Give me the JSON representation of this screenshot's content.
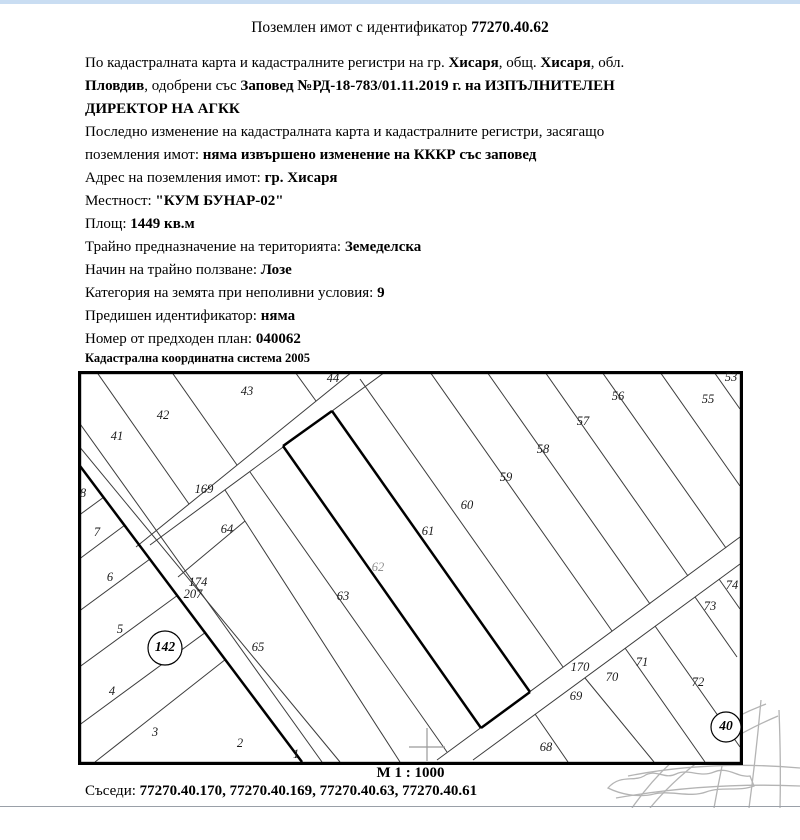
{
  "page": {
    "title_prefix": "Поземлен имот с идентификатор ",
    "title_id": "77270.40.62",
    "paragraphs": [
      [
        {
          "t": "По кадастралната карта и кадастралните регистри на гр. "
        },
        {
          "t": "Хисаря",
          "b": 1
        },
        {
          "t": ", общ. "
        },
        {
          "t": "Хисаря",
          "b": 1
        },
        {
          "t": ", обл. "
        },
        {
          "t": "Пловдив",
          "b": 1
        },
        {
          "t": ", одобрени със "
        },
        {
          "t": "Заповед №РД-18-783/01.11.2019 г. на ИЗПЪЛНИТЕЛЕН ДИРЕКТОР НА АГКК",
          "b": 1
        }
      ],
      [
        {
          "t": "Последно изменение на кадастралната карта и кадастралните регистри, засягащо поземления имот: "
        },
        {
          "t": "няма извършено изменение на КККР със заповед",
          "b": 1
        }
      ],
      [
        {
          "t": "Адрес на поземления имот: "
        },
        {
          "t": "гр. Хисаря",
          "b": 1
        }
      ],
      [
        {
          "t": "Местност: "
        },
        {
          "t": "\"КУМ БУНАР-02\"",
          "b": 1
        }
      ],
      [
        {
          "t": "Площ: "
        },
        {
          "t": "1449 кв.м",
          "b": 1
        }
      ],
      [
        {
          "t": "Трайно предназначение на територията: "
        },
        {
          "t": "Земеделска",
          "b": 1
        }
      ],
      [
        {
          "t": "Начин на трайно ползване: "
        },
        {
          "t": "Лозе",
          "b": 1
        }
      ],
      [
        {
          "t": "Категория на земята при неполивни условия: "
        },
        {
          "t": "9",
          "b": 1
        }
      ],
      [
        {
          "t": "Предишен идентификатор: "
        },
        {
          "t": "няма",
          "b": 1
        }
      ],
      [
        {
          "t": "Номер от предходен план: "
        },
        {
          "t": "040062",
          "b": 1
        }
      ]
    ],
    "coord_system": "Кадастрална координатна система 2005",
    "scale": "М 1 : 1000",
    "neighbors_label": "Съседи: ",
    "neighbors": "77270.40.170, 77270.40.169, 77270.40.63, 77270.40.61"
  },
  "map": {
    "subject_parcel": "62",
    "labels": [
      {
        "t": "41",
        "x": 39,
        "y": 66
      },
      {
        "t": "42",
        "x": 85,
        "y": 45
      },
      {
        "t": "43",
        "x": 169,
        "y": 21
      },
      {
        "t": "44",
        "x": 255,
        "y": 8
      },
      {
        "t": "53",
        "x": 653,
        "y": 7
      },
      {
        "t": "55",
        "x": 630,
        "y": 29
      },
      {
        "t": "56",
        "x": 540,
        "y": 26
      },
      {
        "t": "57",
        "x": 505,
        "y": 51
      },
      {
        "t": "58",
        "x": 465,
        "y": 79
      },
      {
        "t": "59",
        "x": 428,
        "y": 107
      },
      {
        "t": "60",
        "x": 389,
        "y": 135
      },
      {
        "t": "61",
        "x": 350,
        "y": 161
      },
      {
        "t": "62",
        "x": 300,
        "y": 197,
        "gray": 1
      },
      {
        "t": "63",
        "x": 265,
        "y": 226
      },
      {
        "t": "64",
        "x": 149,
        "y": 159
      },
      {
        "t": "65",
        "x": 180,
        "y": 277
      },
      {
        "t": "169",
        "x": 126,
        "y": 119
      },
      {
        "t": "174",
        "x": 120,
        "y": 212
      },
      {
        "t": "207",
        "x": 115,
        "y": 224
      },
      {
        "t": "170",
        "x": 502,
        "y": 297
      },
      {
        "t": "68",
        "x": 468,
        "y": 377
      },
      {
        "t": "69",
        "x": 498,
        "y": 326
      },
      {
        "t": "70",
        "x": 534,
        "y": 307
      },
      {
        "t": "71",
        "x": 564,
        "y": 292
      },
      {
        "t": "72",
        "x": 620,
        "y": 312
      },
      {
        "t": "73",
        "x": 632,
        "y": 236
      },
      {
        "t": "74",
        "x": 654,
        "y": 215
      },
      {
        "t": "8",
        "x": 5,
        "y": 123
      },
      {
        "t": "7",
        "x": 19,
        "y": 162
      },
      {
        "t": "6",
        "x": 32,
        "y": 207
      },
      {
        "t": "5",
        "x": 42,
        "y": 259
      },
      {
        "t": "4",
        "x": 34,
        "y": 321
      },
      {
        "t": "3",
        "x": 77,
        "y": 362
      },
      {
        "t": "2",
        "x": 162,
        "y": 373
      },
      {
        "t": "1",
        "x": 218,
        "y": 384
      }
    ],
    "circles": [
      {
        "t": "142",
        "x": 87,
        "y": 277,
        "r": 17
      },
      {
        "t": "40",
        "x": 648,
        "y": 356,
        "r": 15
      }
    ],
    "colors": {
      "line": "#3c3c3c",
      "bold_line": "#000000",
      "gray_label": "#909090",
      "watermark": "#b4b4b4",
      "topbar": "#c9ddf2",
      "divider": "#9aa0a8"
    }
  }
}
